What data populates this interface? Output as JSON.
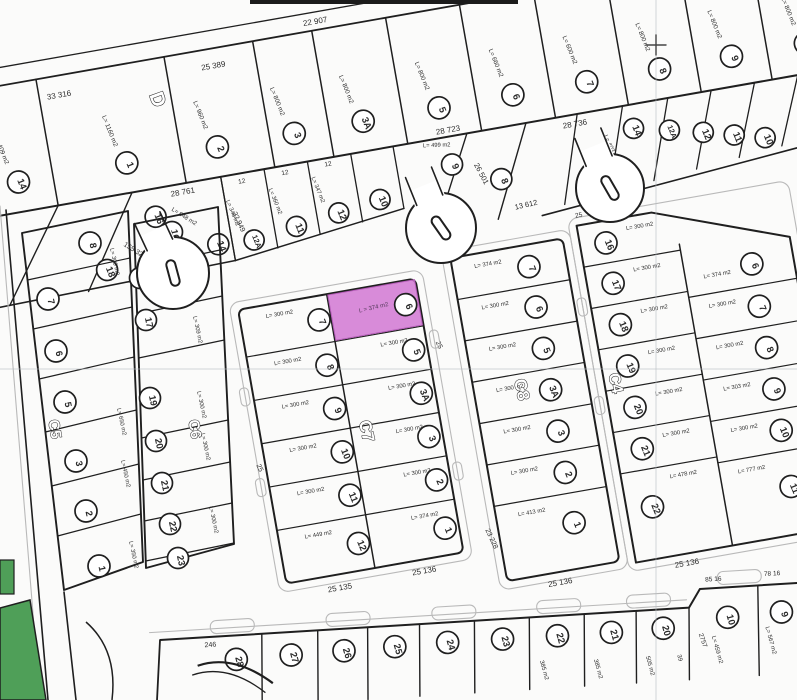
{
  "colors": {
    "highlight": "#cf72d2",
    "highlight_text": "#53395a",
    "green": "#4f9f58",
    "ink": "#1f1f1f",
    "curb": "#b9b9b9",
    "grid": "#b7bcc2"
  },
  "highlight_parcel": {
    "block": "C7",
    "lot": "6",
    "area_label": "L = 374 m2"
  },
  "top_block": {
    "label": "D",
    "top_numbers": [
      "33 316",
      "25 389",
      "22 907"
    ],
    "divider_numbers": [
      "28 761",
      "28 723",
      "28 736"
    ],
    "lots": [
      {
        "n": "14",
        "area": "L= 409 m2"
      },
      {
        "n": "1",
        "area": "L= 1160 m2"
      },
      {
        "n": "2",
        "area": "L= 960 m2"
      },
      {
        "n": "3",
        "area": "L= 800 m2"
      },
      {
        "n": "3A",
        "area": "L= 800 m2"
      },
      {
        "n": "5",
        "area": "L= 800 m2"
      },
      {
        "n": "6",
        "area": "L= 660 m2"
      },
      {
        "n": "7",
        "area": "L= 600 m2"
      },
      {
        "n": "8",
        "area": "L= 800 m2"
      },
      {
        "n": "9",
        "area": "L= 800 m2"
      },
      {
        "n": "10",
        "area": "L= 800 m2"
      }
    ]
  },
  "row2": {
    "left": {
      "lots": [
        "16",
        "14",
        "18"
      ],
      "numbers": [
        "155 32",
        "22 949"
      ],
      "areas": [
        "L= 648 m2"
      ]
    },
    "strips": {
      "width_tick": "12",
      "lots": [
        {
          "n": "12A",
          "area": "L= 348 m2"
        },
        {
          "n": "11",
          "area": "L= 360 m2"
        },
        {
          "n": "12",
          "area": "L= 347 m2"
        },
        {
          "n": "10",
          "area": ""
        }
      ]
    },
    "mid": {
      "lots": [
        {
          "n": "9",
          "area": "L= 499 m2"
        },
        {
          "n": "8",
          "area": ""
        }
      ],
      "numbers": [
        "26 501",
        "13 612"
      ]
    },
    "right": {
      "lots": [
        {
          "n": "14",
          "area": "L= 403 m2"
        },
        {
          "n": "12A",
          "area": ""
        },
        {
          "n": "12",
          "area": ""
        },
        {
          "n": "11",
          "area": ""
        },
        {
          "n": "10",
          "area": ""
        }
      ]
    }
  },
  "blocks": {
    "c5": {
      "label": "C5",
      "lots": [
        {
          "n": "8",
          "area": "L= 309 m2"
        },
        {
          "n": "7",
          "area": ""
        },
        {
          "n": "6",
          "area": ""
        },
        {
          "n": "5",
          "area": "L= 650 m2"
        },
        {
          "n": "3",
          "area": "L= 450 m2"
        },
        {
          "n": "2",
          "area": ""
        },
        {
          "n": "1",
          "area": "L= 350 m2"
        }
      ]
    },
    "c6": {
      "label": "C6",
      "lots": [
        {
          "n": "16",
          "area": ""
        },
        {
          "n": "18",
          "area": ""
        },
        {
          "n": "17",
          "area": "L= 309 m2"
        },
        {
          "n": "19",
          "area": "L= 300 m2"
        },
        {
          "n": "20",
          "area": "L= 300 m2"
        },
        {
          "n": "21",
          "area": ""
        },
        {
          "n": "22",
          "area": "L= 300 m2"
        },
        {
          "n": "23",
          "area": ""
        }
      ]
    },
    "c7": {
      "label": "C7",
      "west": [
        {
          "n": "7",
          "area": "L= 300 m2"
        },
        {
          "n": "8",
          "area": "L= 300 m2"
        },
        {
          "n": "9",
          "area": "L= 300 m2"
        },
        {
          "n": "10",
          "area": "L= 300 m2"
        },
        {
          "n": "11",
          "area": "L= 300 m2"
        },
        {
          "n": "12",
          "area": "L= 449 m2"
        }
      ],
      "east": [
        {
          "n": "6",
          "area": "L = 374 m2"
        },
        {
          "n": "5",
          "area": "L= 300 m2"
        },
        {
          "n": "3A",
          "area": "L= 300 m2"
        },
        {
          "n": "3",
          "area": "L= 300 m2"
        },
        {
          "n": "2",
          "area": "L= 300 m2"
        },
        {
          "n": "1",
          "area": "L= 374 m2"
        }
      ],
      "bottom_numbers": [
        "25 135",
        "25 136"
      ],
      "road_tick": "25"
    },
    "c8": {
      "label": "C8",
      "lots": [
        {
          "n": "7",
          "area": "L= 374 m2"
        },
        {
          "n": "6",
          "area": "L= 300 m2"
        },
        {
          "n": "5",
          "area": "L= 300 m2"
        },
        {
          "n": "3A",
          "area": "L= 300 m2"
        },
        {
          "n": "3",
          "area": "L= 300 m2"
        },
        {
          "n": "2",
          "area": "L= 300 m2"
        },
        {
          "n": "1",
          "area": "L= 413 m2"
        }
      ],
      "bottom_numbers": [
        "25 136"
      ],
      "side_number": "23 228"
    },
    "c4": {
      "label": "C4",
      "west": [
        {
          "n": "16",
          "area": "L= 300 m2"
        },
        {
          "n": "17",
          "area": "L= 300 m2"
        },
        {
          "n": "18",
          "area": "L= 300 m2"
        },
        {
          "n": "19",
          "area": "L= 300 m2"
        },
        {
          "n": "20",
          "area": "L= 300 m2"
        },
        {
          "n": "21",
          "area": "L= 300 m2"
        },
        {
          "n": "22",
          "area": "L= 478 m2"
        }
      ],
      "east": [
        {
          "n": "6",
          "area": "L= 374 m2"
        },
        {
          "n": "7",
          "area": "L= 300 m2"
        },
        {
          "n": "8",
          "area": "L= 300 m2"
        },
        {
          "n": "9",
          "area": "L= 303 m2"
        },
        {
          "n": "10",
          "area": "L= 300 m2"
        },
        {
          "n": "11",
          "area": "L= 777 m2"
        }
      ],
      "bottom_numbers": [
        "25 136"
      ],
      "side_number": "38 148",
      "road_tick": "25"
    }
  },
  "bottom_strip": {
    "lots": [
      {
        "n": "28",
        "area": "246"
      },
      {
        "n": "27",
        "area": ""
      },
      {
        "n": "26",
        "area": ""
      },
      {
        "n": "25",
        "area": ""
      },
      {
        "n": "24",
        "area": ""
      },
      {
        "n": "23",
        "area": ""
      },
      {
        "n": "22",
        "area": "385 m2"
      },
      {
        "n": "21",
        "area": "385 m2"
      },
      {
        "n": "20",
        "area": "505 m2"
      },
      {
        "n": "10",
        "area": "L= 459 m2"
      },
      {
        "n": "9",
        "area": "L= 567 m2"
      }
    ],
    "corner_numbers": [
      "85 16",
      "78 16"
    ],
    "edge_number": "2757",
    "extra_number": "39"
  }
}
